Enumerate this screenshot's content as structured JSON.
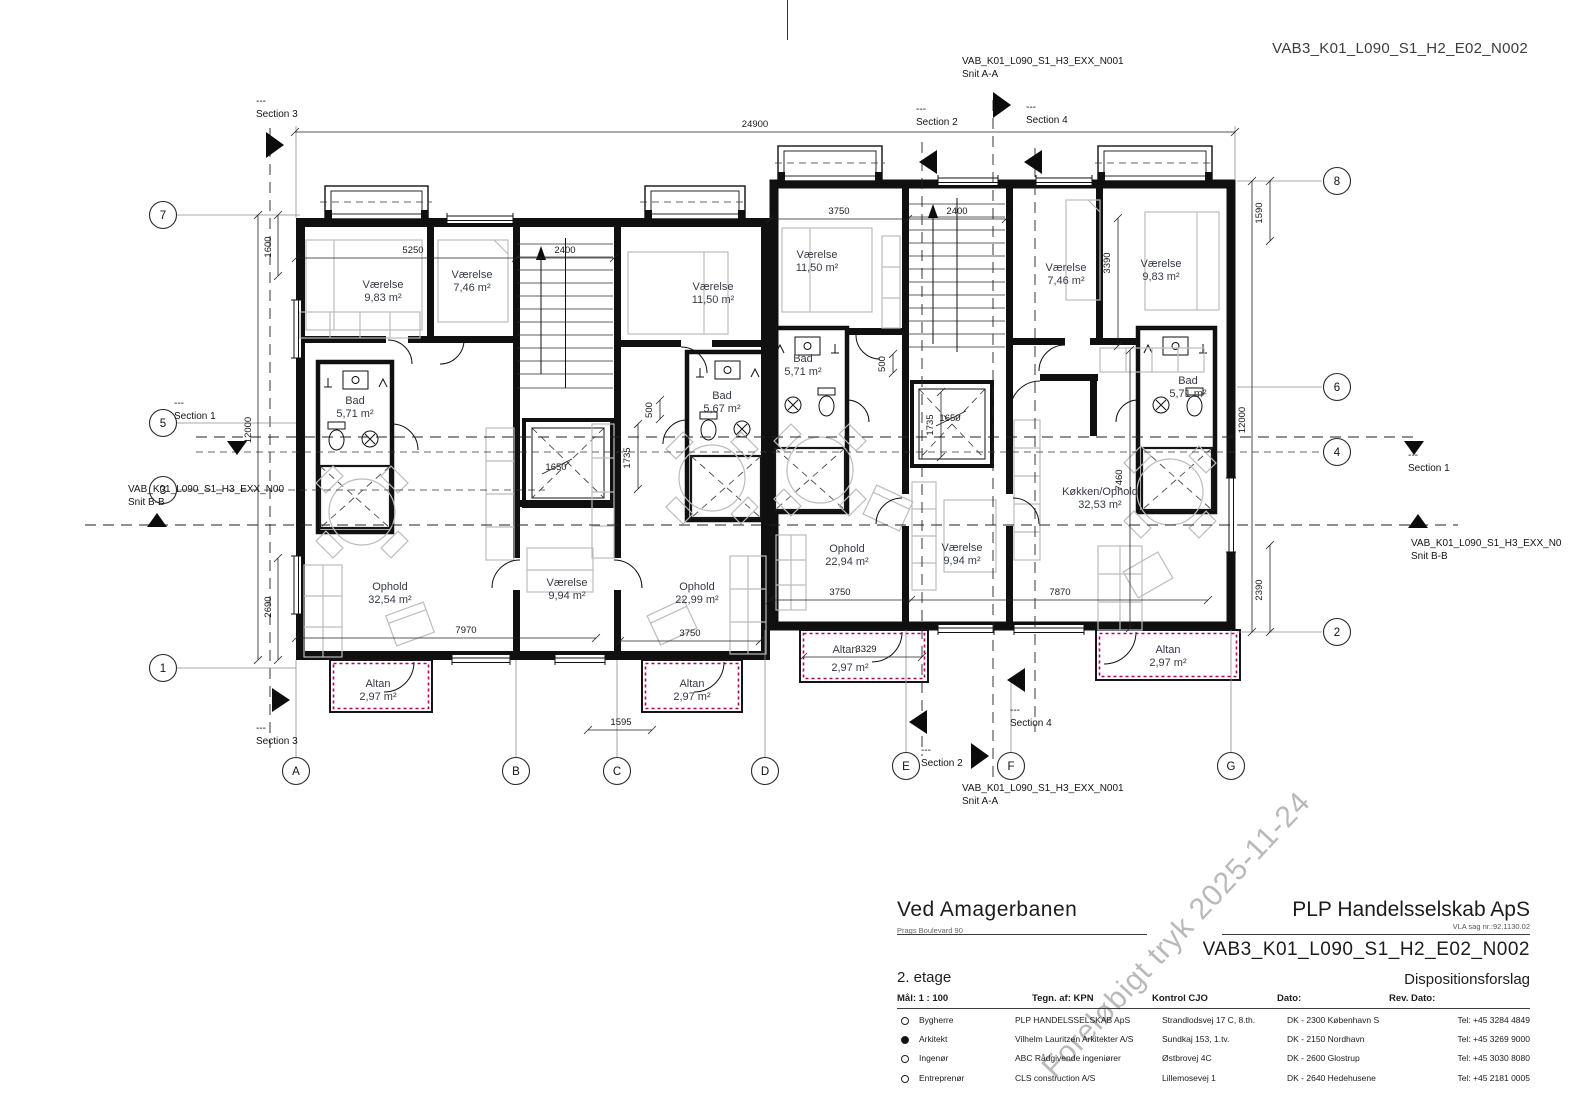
{
  "page": {
    "code_top_right": "VAB3_K01_L090_S1_H2_E02_N002"
  },
  "watermark": "Foreløbigt tryk 2025-11-24",
  "sections": {
    "dash": "---",
    "s1": "Section 1",
    "s2": "Section 2",
    "s3": "Section 3",
    "s4": "Section 4"
  },
  "section_refs": {
    "code_aa": "VAB_K01_L090_S1_H3_EXX_N001",
    "snit_aa": "Snit A-A",
    "code_bb_left": "VAB_K01_L090_S1_H3_EXX_N00",
    "code_bb_right": "VAB_K01_L090_S1_H3_EXX_N0",
    "snit_bb": "Snit B-B"
  },
  "grid": {
    "left": [
      "7",
      "5",
      "3",
      "1"
    ],
    "right": [
      "8",
      "6",
      "4",
      "2"
    ],
    "bottom": [
      "A",
      "B",
      "C",
      "D",
      "E",
      "F",
      "G"
    ]
  },
  "rooms": {
    "v983": {
      "name": "Værelse",
      "area": "9,83 m²"
    },
    "v746": {
      "name": "Værelse",
      "area": "7,46 m²"
    },
    "v1150": {
      "name": "Værelse",
      "area": "11,50 m²"
    },
    "v994": {
      "name": "Værelse",
      "area": "9,94 m²"
    },
    "bad571": {
      "name": "Bad",
      "area": "5,71 m²"
    },
    "bad567": {
      "name": "Bad",
      "area": "5,67 m²"
    },
    "ophold3254": {
      "name": "Ophold",
      "area": "32,54 m²"
    },
    "ophold2299": {
      "name": "Ophold",
      "area": "22,99 m²"
    },
    "ophold2294": {
      "name": "Ophold",
      "area": "22,94 m²"
    },
    "kokken3253": {
      "name": "Køkken/Ophold",
      "area": "32,53 m²"
    },
    "altan": {
      "name": "Altan",
      "area": "2,97 m²"
    }
  },
  "dims": {
    "d24900": "24900",
    "d5250": "5250",
    "d2400": "2400",
    "d3750": "3750",
    "d1600": "1600",
    "d12000": "12000",
    "d2690": "2690",
    "d1590": "1590",
    "d2390": "2390",
    "d3390": "3390",
    "d7460": "7460",
    "d7970": "7970",
    "d7870": "7870",
    "d3329": "3329",
    "d1595": "1595",
    "d1650": "1650",
    "d1735": "1735",
    "d500": "500"
  },
  "titleblock": {
    "project": "Ved Amagerbanen",
    "address": "Prags Boulevard 90",
    "client": "PLP Handelsselskab ApS",
    "case_no": "VLA sag nr.:92.1130.02",
    "drawing_no": "VAB3_K01_L090_S1_H2_E02_N002",
    "floor": "2. etage",
    "phase": "Dispositionsforslag",
    "scale_label": "Mål: 1 : 100",
    "drawn_label": "Tegn. af: KPN",
    "control_label": "Kontrol CJO",
    "date_label": "Dato:",
    "rev_label": "Rev. Dato:",
    "parties": [
      {
        "marker": "open",
        "role": "Bygherre",
        "company": "PLP HANDELSSELSKAB ApS",
        "address": "Strandlodsvej 17 C, 8.th.",
        "city": "DK - 2300 København S",
        "phone": "Tel: +45 3284 4849"
      },
      {
        "marker": "filled",
        "role": "Arkitekt",
        "company": "Vilhelm Lauritzen Arkitekter A/S",
        "address": "Sundkaj 153, 1.tv.",
        "city": "DK - 2150 Nordhavn",
        "phone": "Tel: +45 3269 9000"
      },
      {
        "marker": "open",
        "role": "Ingenør",
        "company": "ABC Rådgivende ingeniører",
        "address": "Østbrovej 4C",
        "city": "DK - 2600 Glostrup",
        "phone": "Tel: +45 3030 8080"
      },
      {
        "marker": "open",
        "role": "Entreprenør",
        "company": "CLS construction A/S",
        "address": "Lillemosevej 1",
        "city": "DK - 2640 Hedehusene",
        "phone": "Tel: +45 2181 0005"
      }
    ]
  }
}
